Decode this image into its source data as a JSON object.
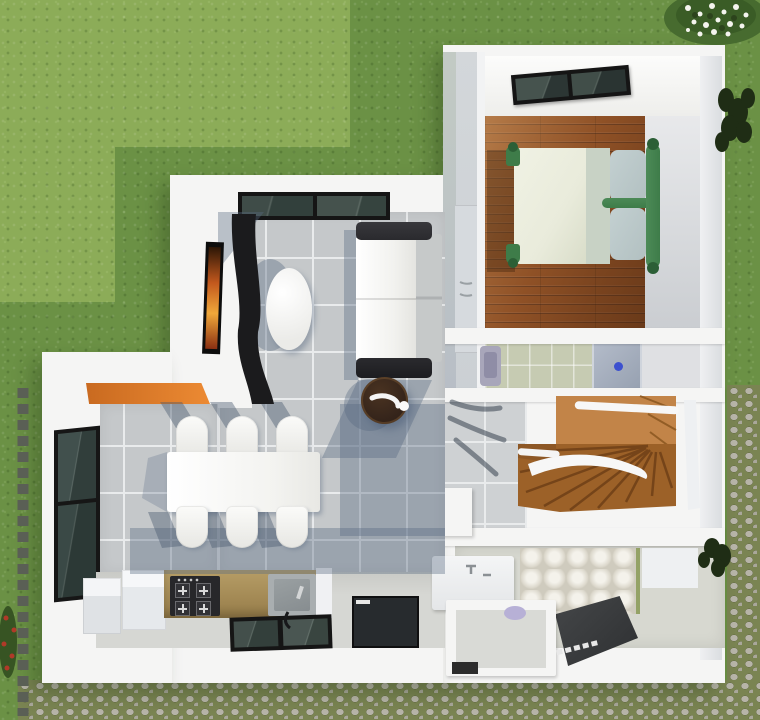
{
  "scene": {
    "description": "top-down 3D rendered floor plan of a small one-bedroom house surrounded by a lawn and a cobblestone path",
    "rooms": [
      {
        "id": "bedroom",
        "floor": "hardwood-planks",
        "items": [
          "skylight-window",
          "double-bed-green-frame",
          "two-pillows",
          "wardrobe-niche"
        ]
      },
      {
        "id": "living-room",
        "floor": "grey-ceramic-tile",
        "items": [
          "picture-window",
          "wall-mounted-tv",
          "curved-tv-cabinet",
          "oval-side-table",
          "white-sofa-black-armrests",
          "round-dark-coffee-table"
        ]
      },
      {
        "id": "dining-area",
        "floor": "grey-ceramic-tile",
        "items": [
          "white-dining-table",
          "six-dining-chairs",
          "orange-bar-counter"
        ]
      },
      {
        "id": "kitchen",
        "items": [
          "side-window",
          "refrigerator-boxes",
          "olive-countertop",
          "four-burner-hob",
          "sink",
          "south-window"
        ]
      },
      {
        "id": "bathroom-upper",
        "items": [
          "washbasin",
          "shower-tray-blue-drain"
        ]
      },
      {
        "id": "stair-hall",
        "floor": "grey-ceramic-tile",
        "items": [
          "wooden-winder-staircase",
          "white-handrails",
          "plant-shadow"
        ]
      },
      {
        "id": "bathroom-lower",
        "items": [
          "vanity-basin",
          "toilet-compartment",
          "dark-walk-in-shower",
          "textured-tile-wall"
        ]
      },
      {
        "id": "entry",
        "items": [
          "dark-entry-door-panel"
        ]
      }
    ],
    "exterior": {
      "top_left": "lawn-with-light-mown-patch",
      "right": "lawn-then-cobblestone-path",
      "bottom": "cobblestone-path",
      "features": [
        "stepping-stones",
        "white-flower-shrub",
        "dark-shrubs",
        "red-flowers"
      ]
    },
    "counts": {
      "dining_chairs": 6,
      "hob_burners": 4,
      "stair_steps": 9,
      "bed_pillows": 2,
      "window_panes_living": 2
    }
  },
  "palette": {
    "grass-light": "#8cac58",
    "grass-dark": "#6b9145",
    "gravel-moss": "#7a8452",
    "gravel-stone": "#b7b4a8",
    "gravel-stone2": "#a9a79a",
    "stone-step": "#5a5f55",
    "wall-white": "#f5f5f4",
    "wall-face": "#c2cac4",
    "tile": "#c5c8ca",
    "tile-light": "#ced1d3",
    "grout": "#e9ebec",
    "wood-mid": "#8f5126",
    "stair-light": "#c28448",
    "stair-dark": "#9c6128",
    "sofa-arm": "#2a2a2e",
    "sofa-seat": "#f2f2ef",
    "sofa-back": "#c6c9c9",
    "oval-white": "#fdfdfc",
    "ctable-dark": "#33231a",
    "bed-green": "#3e7c49",
    "mattress": "#e9ebdb",
    "blanket": "#c8d2c5",
    "pillow": "#b2c0c1",
    "bar-orange": "#e0792a",
    "counter-olive": "#a68d56",
    "stove-black": "#27272a",
    "sink-gray": "#a9aeb0",
    "glass-dark": "#3a4743",
    "frame-black": "#151515",
    "bath-floor-green": "#c6cbb2",
    "shower-tray": "#a9b2c0",
    "drain-blue": "#3c50cf",
    "bath2-floor": "#d7d8d0",
    "bump-tile": "#e9e6dd",
    "shower-dark": "#3b3d3f",
    "door-dark": "#272b2e",
    "light-floor": "#d6d7d3",
    "east-floor": "#e2e3e5",
    "closet": "#d6dade"
  }
}
